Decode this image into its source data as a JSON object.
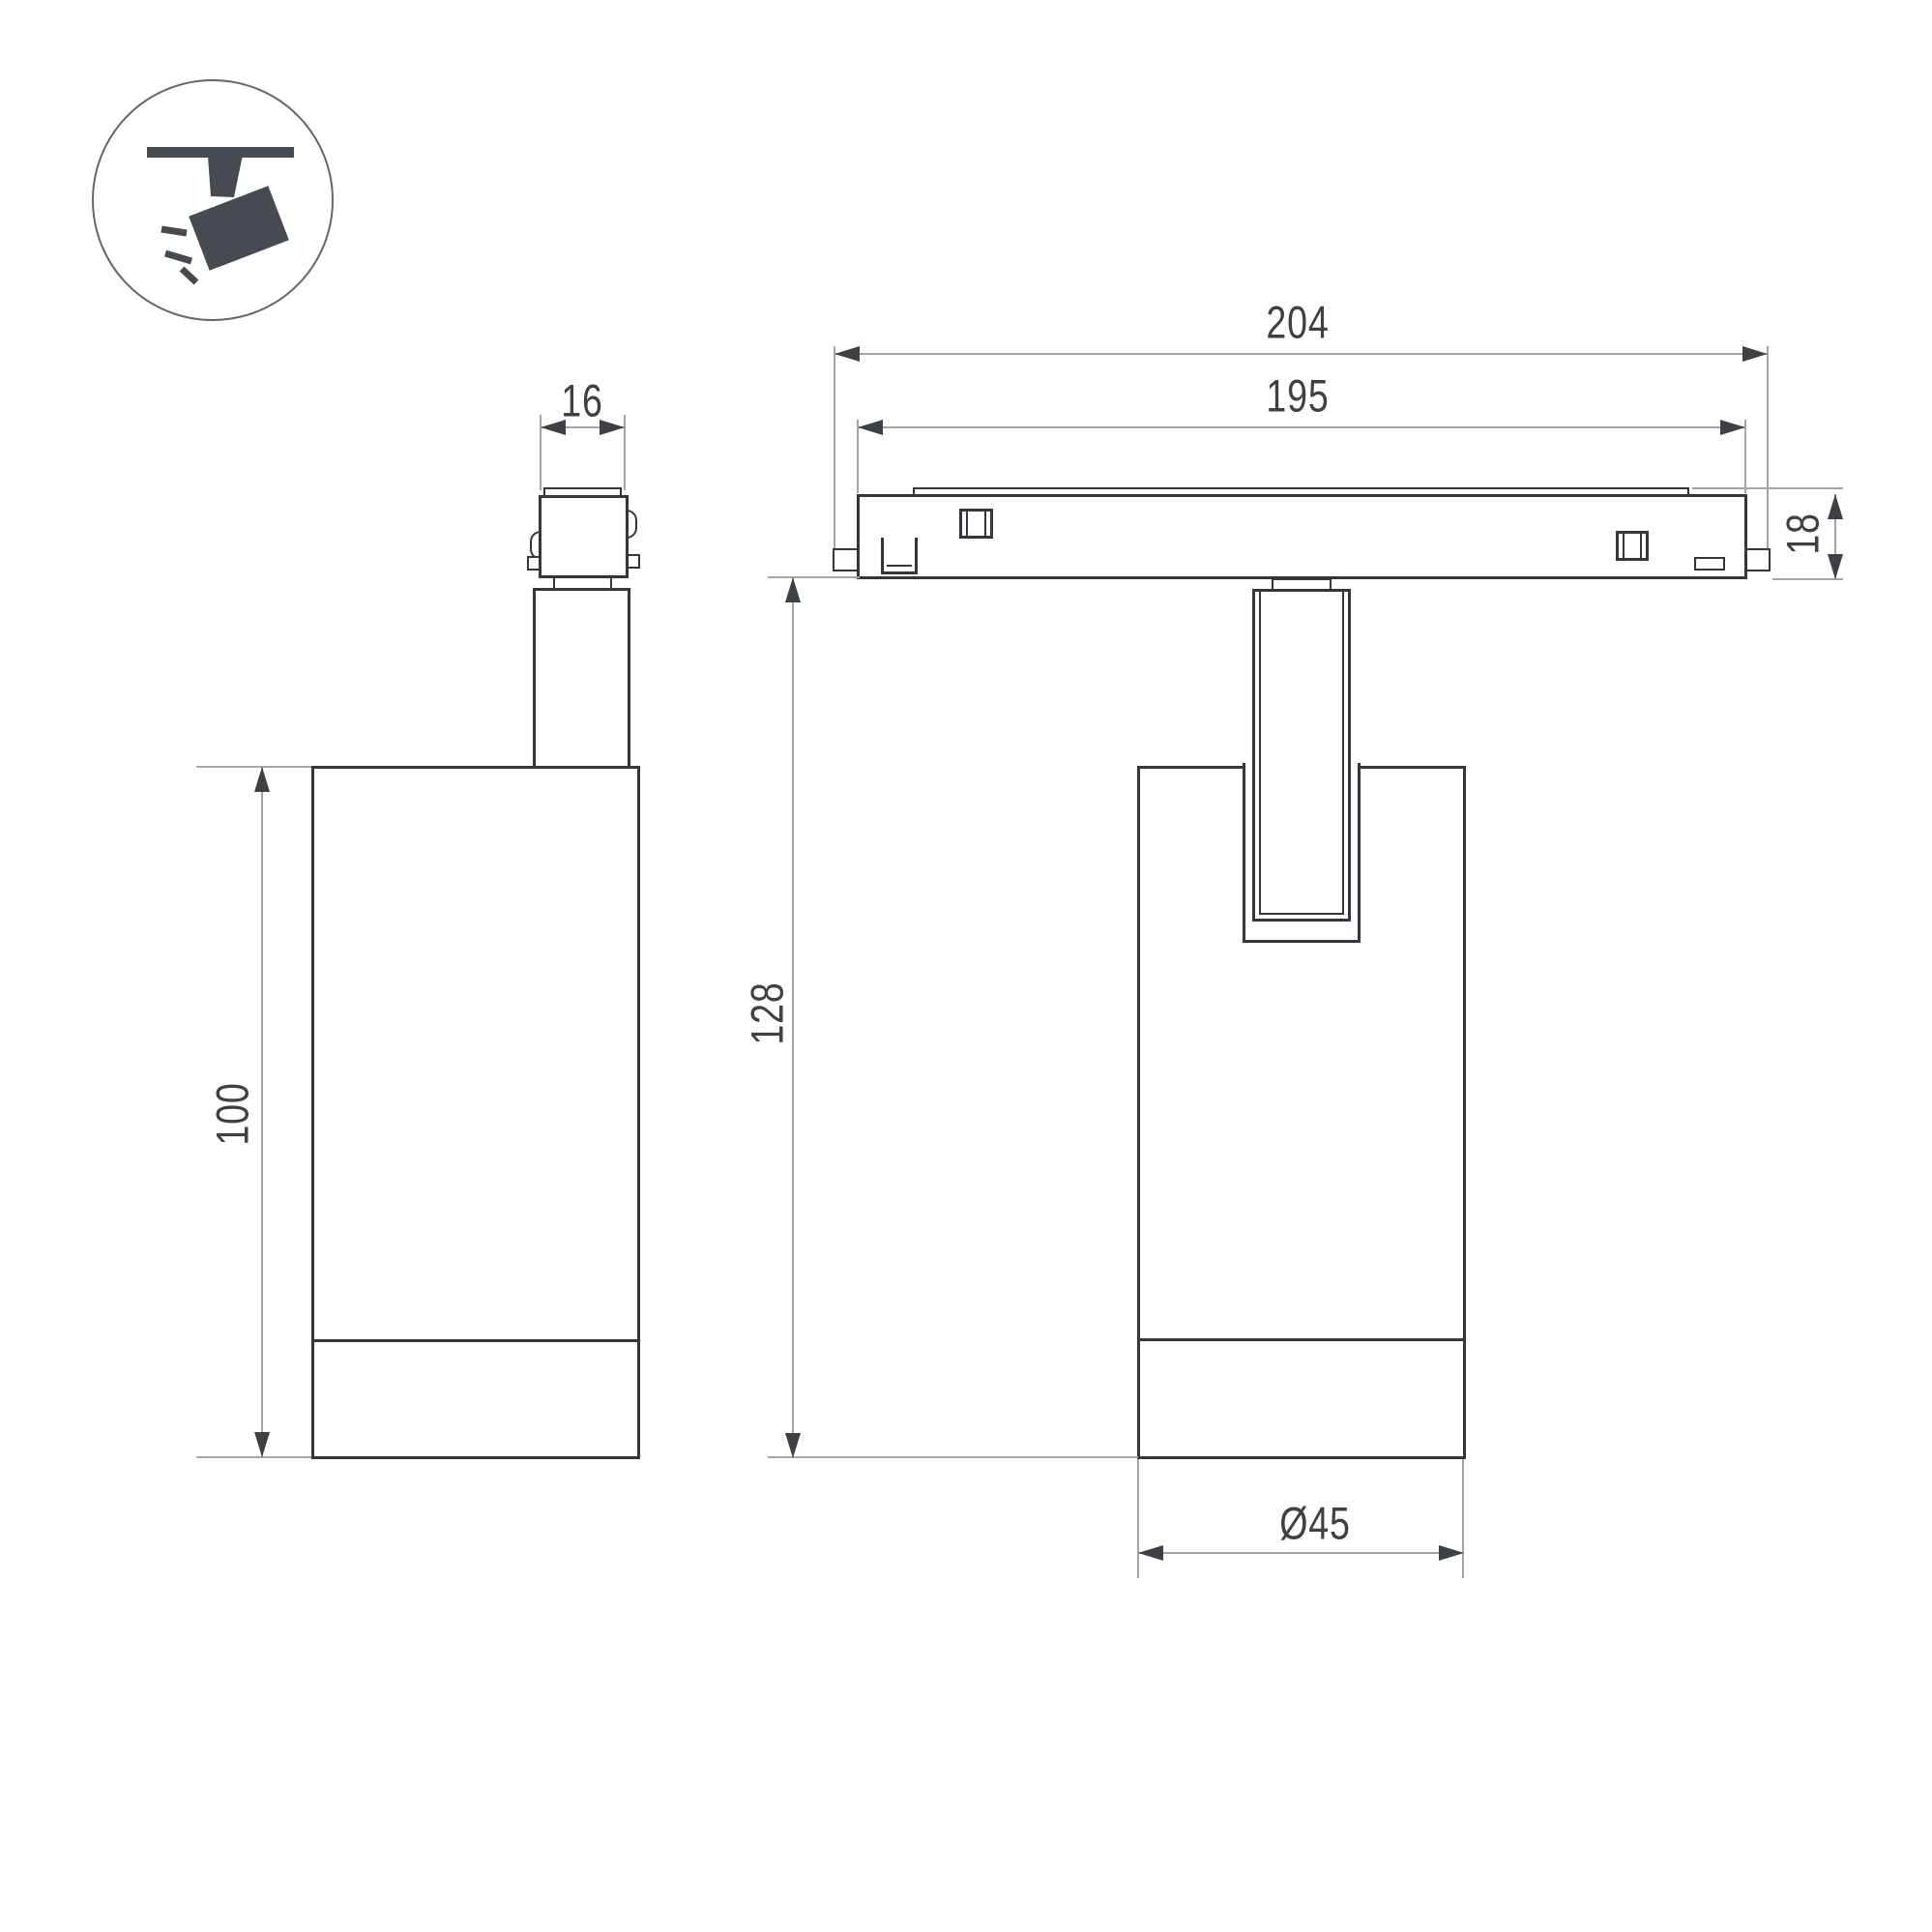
{
  "drawing": {
    "title": "track spotlight dimension drawing",
    "labels": {
      "adapter_width": "16",
      "body_height": "100",
      "track_length_outer": "204",
      "track_length_inner": "195",
      "track_height": "18",
      "overall_height": "128",
      "body_diameter": "Ø45"
    },
    "icon": {
      "name": "track-spotlight-icon",
      "description": "spotlight hanging from track, tilted, with light rays"
    },
    "colors": {
      "outline": "#33373b",
      "dimension_line": "#a3a5a8",
      "text": "#3d4145",
      "icon": "#464b51",
      "background": "#ffffff"
    }
  }
}
